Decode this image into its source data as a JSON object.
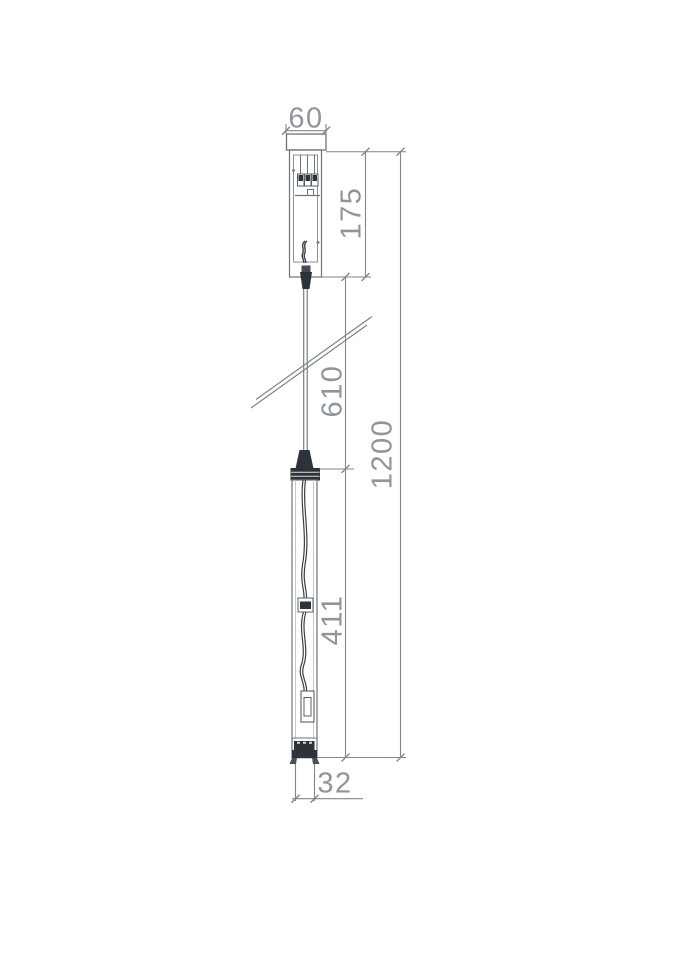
{
  "drawing": {
    "type": "technical-dimension-drawing",
    "subject": "pendant-light-fixture",
    "labels": {
      "canopy_width": "60",
      "canopy_height": "175",
      "cable_length": "610",
      "total_height": "1200",
      "fixture_length": "411",
      "tube_diameter": "32"
    },
    "colors": {
      "object_line": "#6e747b",
      "dimension_line": "#81878e",
      "dark_fill": "#2e333a",
      "label_text": "#8f959b",
      "background": "#ffffff"
    }
  }
}
